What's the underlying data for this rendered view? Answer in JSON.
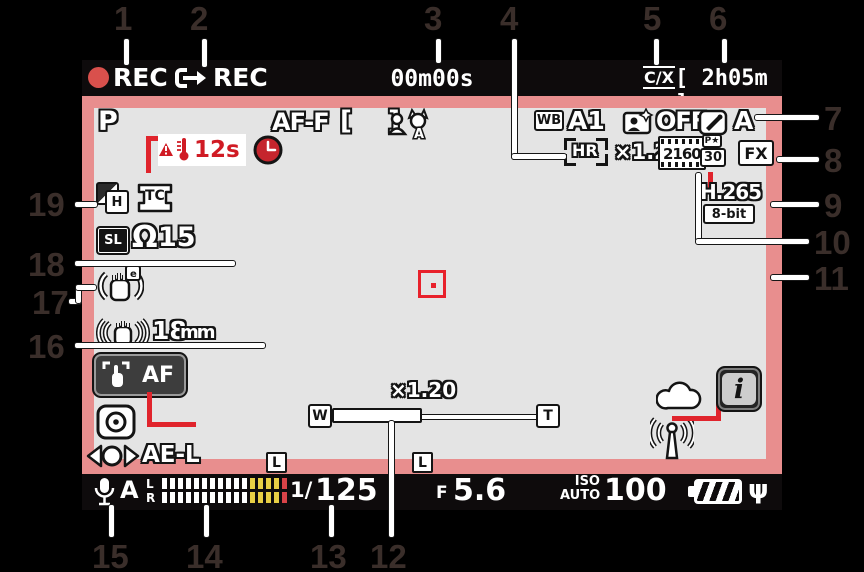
{
  "callouts": {
    "c1": "1",
    "c2": "2",
    "c3": "3",
    "c4": "4",
    "c5": "5",
    "c6": "6",
    "c7": "7",
    "c8": "8",
    "c9": "9",
    "c10": "10",
    "c11": "11",
    "c12": "12",
    "c13": "13",
    "c14": "14",
    "c15": "15",
    "c16": "16",
    "c17": "17",
    "c18": "18",
    "c19": "19"
  },
  "icons": {
    "af_area_brackets": "[    ]",
    "headphone": "Ω",
    "ac_plug": "ψ"
  },
  "screen": {
    "top_bar": {
      "rec_label": "REC",
      "ext_rec_label": "REC",
      "elapsed_time": "00m00s",
      "slot_indicator": "C/X",
      "time_remaining": "[ 2h05m ]"
    },
    "indicators_row1": {
      "exposure_mode": "P",
      "focus_mode": "AF-F",
      "subject_detect": "A",
      "wb_label": "WB",
      "wb_value": "A1",
      "portrait_balance_value": "OFF",
      "picture_control_value": "A"
    },
    "indicators_row2": {
      "temp_countdown": "12s",
      "hires_zoom_label": "HR",
      "hires_zoom_value": "×1.20",
      "frame_size": "2160",
      "quality_badge": "P★",
      "frame_rate": "30",
      "image_area": "FX"
    },
    "codec": {
      "type": "H.265",
      "bit_depth": "8-bit"
    },
    "left_column": {
      "tone_mode": "H",
      "timecode": "TC",
      "sl_label": "SL",
      "headphone_volume": "15",
      "focal_length": "18",
      "focal_unit": "mm",
      "touch_af": "AF",
      "ae_lock": "AE-L"
    },
    "zoom_bar": {
      "magnification": "×1.20",
      "wide": "W",
      "tele": "T",
      "fill_percent": 44
    },
    "bottom_bar": {
      "mic_sensitivity": "A",
      "channel_left": "L",
      "channel_right": "R",
      "lock_indicator": "L",
      "shutter_prefix": "1/",
      "shutter_value": "125",
      "aperture_label": "F",
      "aperture_value": "5.6",
      "iso_label": "ISO",
      "iso_mode": "AUTO",
      "iso_value": "100"
    }
  },
  "audio_meter": {
    "white_bars": 11,
    "yellow_bars": 4,
    "red_bars": 1
  },
  "colors": {
    "frame_pink": "#e88e8e",
    "warning_red": "#d01b24",
    "meter_yellow": "#e8cf45",
    "meter_red": "#d94348"
  }
}
